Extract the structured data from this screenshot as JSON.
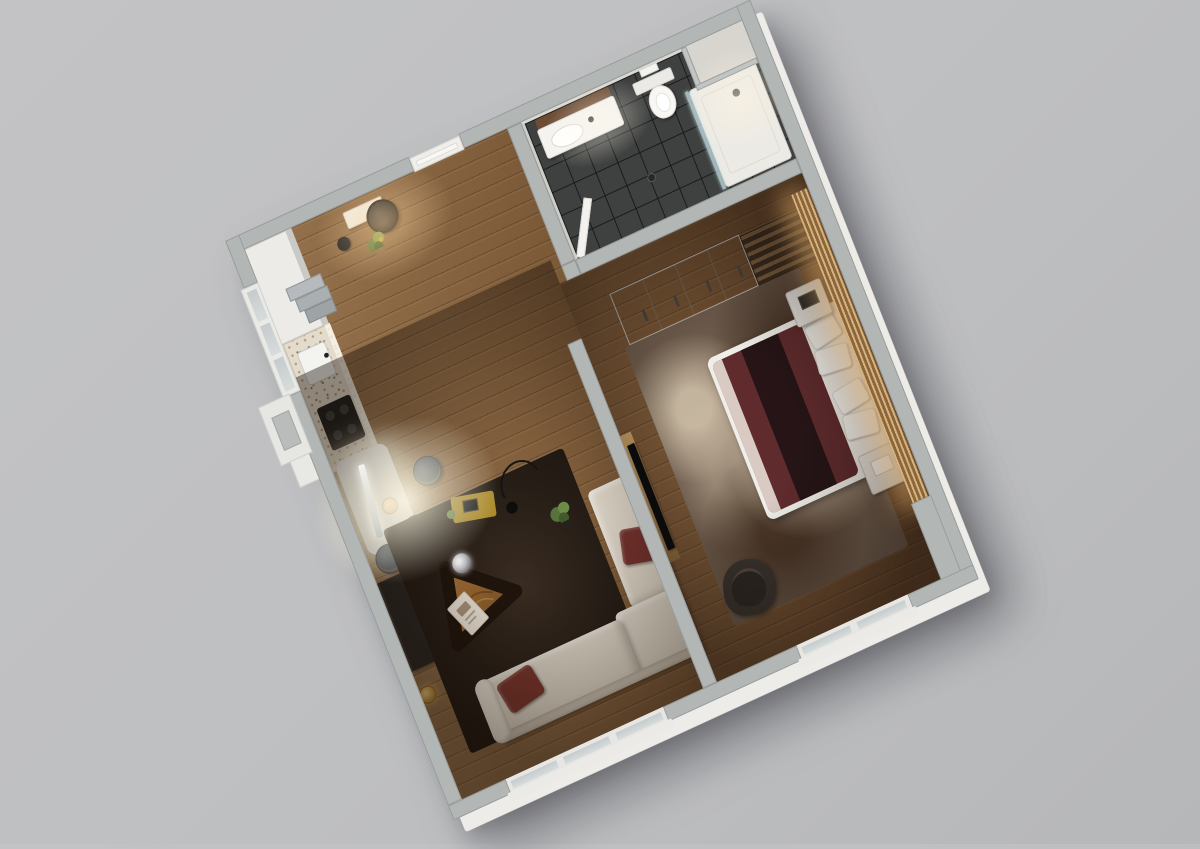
{
  "scene": {
    "title": "3D apartment floor plan render",
    "view": "top-down isometric, plan rotated about 27 degrees",
    "background_color": "#bfc0c2",
    "palette": {
      "wall_top": "#b2b6b5",
      "wall_face_white": "#edece8",
      "wood_floor_light": "#97744e",
      "wood_floor_dark": "#5f4128",
      "bathroom_tile": "#3f4140",
      "living_rug": "#241c15",
      "bedroom_rug": "#705e4e",
      "sofa_cream": "#d8d0c2",
      "duvet_maroon": "#5f2b2d",
      "accent_pillow_maroon": "#70302c",
      "coffee_table_wood": "#a8713d",
      "led_glow_amber": "#ffc378",
      "dining_glow_warm": "#fff6dc",
      "gold_lamp": "#d9b05e"
    },
    "rooms": [
      {
        "id": "living",
        "name": "Living room with open kitchen",
        "floor": "wood planks",
        "furniture": [
          "kitchen counter with terrazzo top",
          "dark cooktop",
          "kitchen sink",
          "white storage block",
          "step shelf",
          "illuminated dining table",
          "metal linear pendant lamp",
          "round diffuser",
          "3 dark barrel dining chairs",
          "dark sideboard",
          "gold table lamp",
          "dark area rug",
          "triangular wooden coffee table",
          "mirror-ball decor",
          "magazine",
          "cream corner sofa",
          "2 maroon pillows",
          "potted plant",
          "arc floor lamp",
          "yellow throw with book"
        ]
      },
      {
        "id": "entry",
        "name": "Entry hall",
        "floor": "wood planks",
        "furniture": [
          "front door",
          "console table",
          "round black mirror",
          "potted plant",
          "dark vase"
        ]
      },
      {
        "id": "bathroom",
        "name": "Bathroom",
        "floor": "dark gray tiles",
        "furniture": [
          "vanity with washbasin and black faucet",
          "wall-hung toilet with flush plate",
          "walk-in shower with glass screen",
          "floor drain",
          "open door",
          "storage niche"
        ]
      },
      {
        "id": "bedroom",
        "name": "Bedroom",
        "floor": "wood planks",
        "furniture": [
          "wardrobe with four doors",
          "slatted open shelf unit",
          "double bed with maroon duvet and white pillows",
          "two white nightstands",
          "mottled beige-brown rug",
          "dark armchair",
          "wall-mounted TV on wood panel",
          "amber LED backlit slat feature wall"
        ]
      }
    ],
    "openings": {
      "front_door": "white door on north-west wall",
      "west_window_bay": "glazed bay beside kitchen with exterior box",
      "living_south_window": "three-pane window in south wall",
      "bedroom_south_window": "two-pane window in south wall"
    },
    "lighting": [
      "bright pendant glow over dining table",
      "warm glow at entry console",
      "ceiling light in shower zone",
      "amber LED strip along bedroom feature wall"
    ]
  }
}
